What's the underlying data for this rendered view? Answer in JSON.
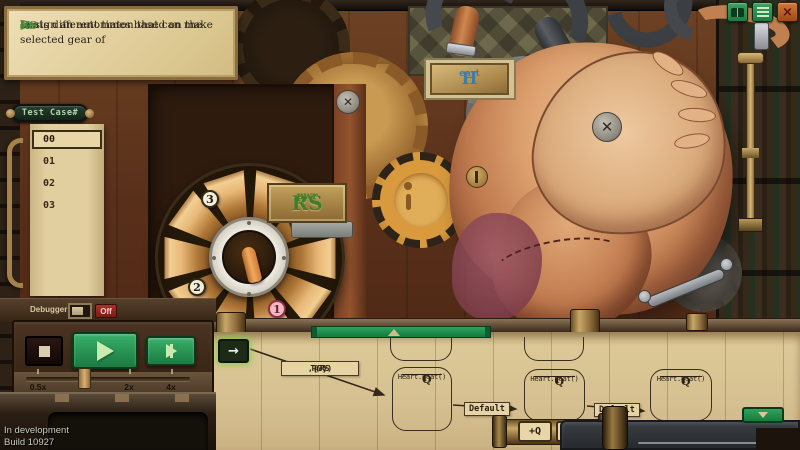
{
  "colors": {
    "accent_green": "#2fa35d",
    "timeline_green": "#1f9350",
    "parchment": "#d6c091",
    "brass": "#b08d4e",
    "wood_dark": "#4a2413",
    "status_off_red": "#a02828",
    "heart_label_blue": "#3f7da2",
    "selector_label_green": "#4a8a30",
    "ink": "#2b2218"
  },
  "instructions": {
    "part1": "Design an automaton that can make ",
    "heart_big": "H",
    "heart_small": "eart",
    "part2": " beats different times based on the selected gear of ",
    "rs_big": "RS",
    "rs_small": "pwr"
  },
  "topbar": {
    "buttons": [
      {
        "icon": "book"
      },
      {
        "icon": "menu"
      },
      {
        "icon": "close",
        "glyph": "×"
      }
    ]
  },
  "test_cases": {
    "title": "Test Case#",
    "items": [
      {
        "label": "00",
        "selected": true
      },
      {
        "label": "01",
        "selected": false
      },
      {
        "label": "02",
        "selected": false
      },
      {
        "label": "03",
        "selected": false
      }
    ]
  },
  "debug": {
    "label": "Debugger",
    "state": "Off"
  },
  "playback": {
    "speed_labels": [
      "0.5x",
      "2x",
      "4x"
    ]
  },
  "selector": {
    "name_big": "RS",
    "name_small": "pwr",
    "positions": [
      "3",
      "0",
      "2",
      "1"
    ],
    "selected_position": "1"
  },
  "heart": {
    "name_big": "H",
    "name_small": "eart"
  },
  "diagram": {
    "start_arrow": "→",
    "transition": {
      "prefix": "T(RS",
      "sub": "pwr",
      "suffix": ",{3})"
    },
    "nodes": [
      {
        "title": "Q",
        "sub": "1",
        "body": "Heart.Beat()"
      },
      {
        "title": "Q",
        "sub": "1",
        "body": "Heart.Beat()"
      },
      {
        "title": "Q",
        "sub": "1",
        "body": "Heart.Beat()"
      }
    ],
    "edges": [
      {
        "label": "Default"
      },
      {
        "label": "Default"
      }
    ],
    "add_state_label": "+Q"
  },
  "footer": {
    "line1": "In development",
    "line2": "Build 10927"
  }
}
